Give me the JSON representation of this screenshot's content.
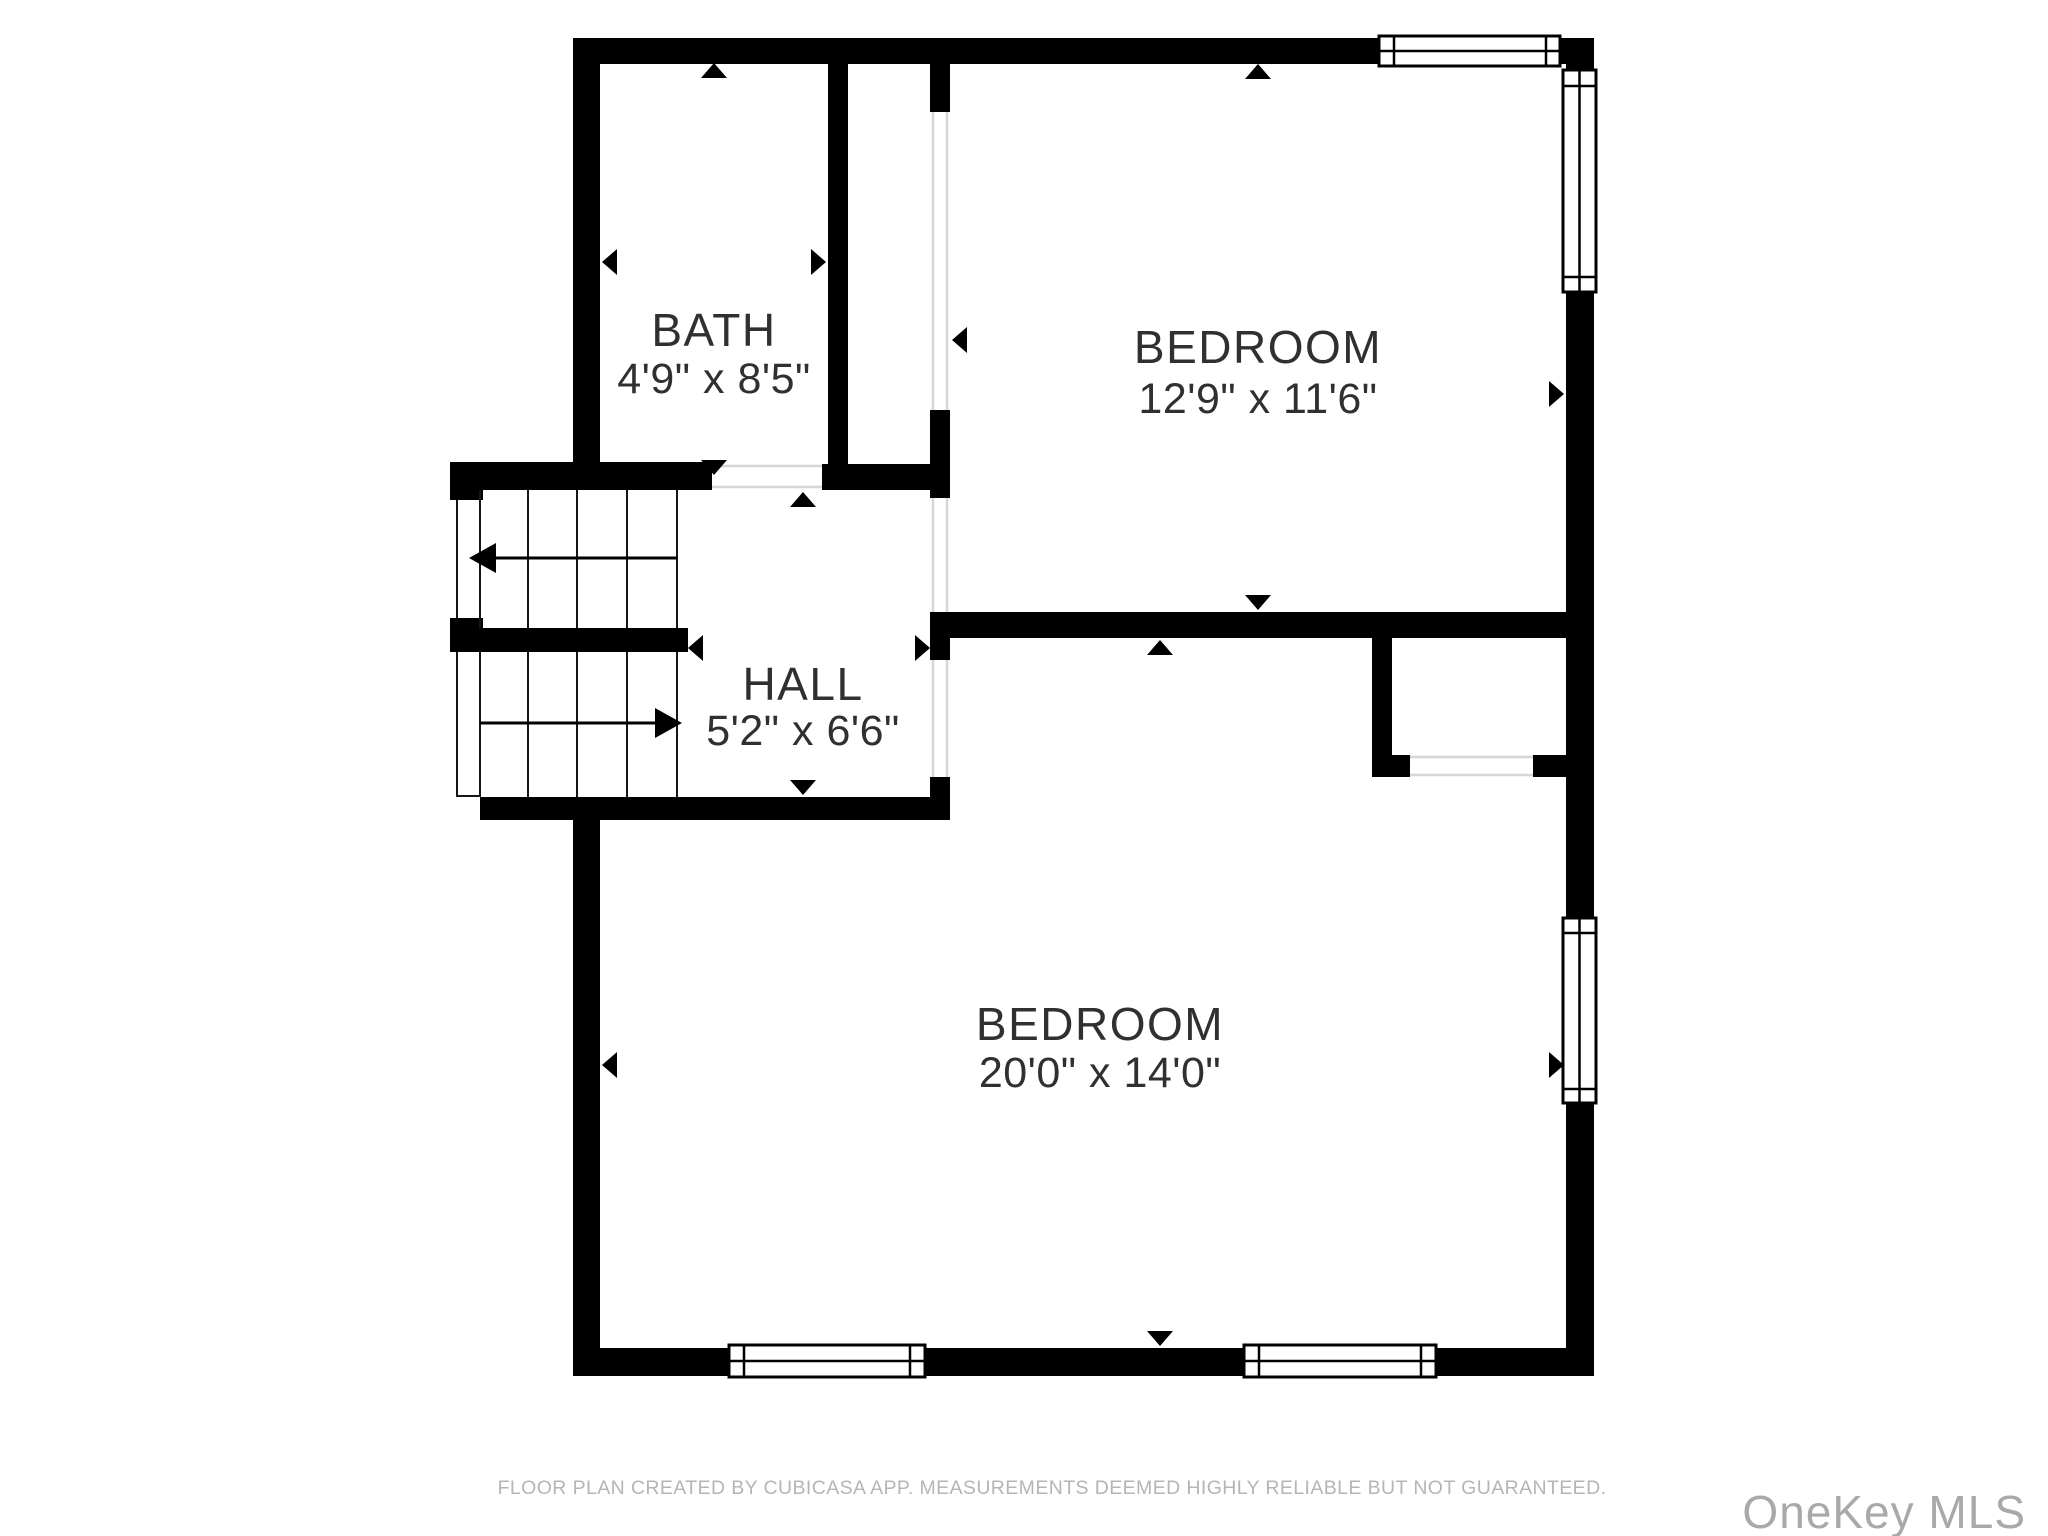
{
  "plan": {
    "rooms": [
      {
        "id": "bath",
        "name": "BATH",
        "dimensions": "4'9\" x 8'5\""
      },
      {
        "id": "bedroom-top",
        "name": "BEDROOM",
        "dimensions": "12'9\" x 11'6\""
      },
      {
        "id": "hall",
        "name": "HALL",
        "dimensions": "5'2\" x 6'6\""
      },
      {
        "id": "bedroom-bottom",
        "name": "BEDROOM",
        "dimensions": "20'0\" x 14'0\""
      }
    ]
  },
  "footer": {
    "disclaimer": "FLOOR PLAN CREATED BY CUBICASA APP. MEASUREMENTS DEEMED HIGHLY RELIABLE BUT NOT GUARANTEED."
  },
  "watermark": {
    "text": "OneKey MLS"
  },
  "colors": {
    "wall": "#000000",
    "label": "#303030",
    "footer": "#b5b5b5",
    "watermark": "#a9a9a9",
    "background": "#ffffff"
  }
}
